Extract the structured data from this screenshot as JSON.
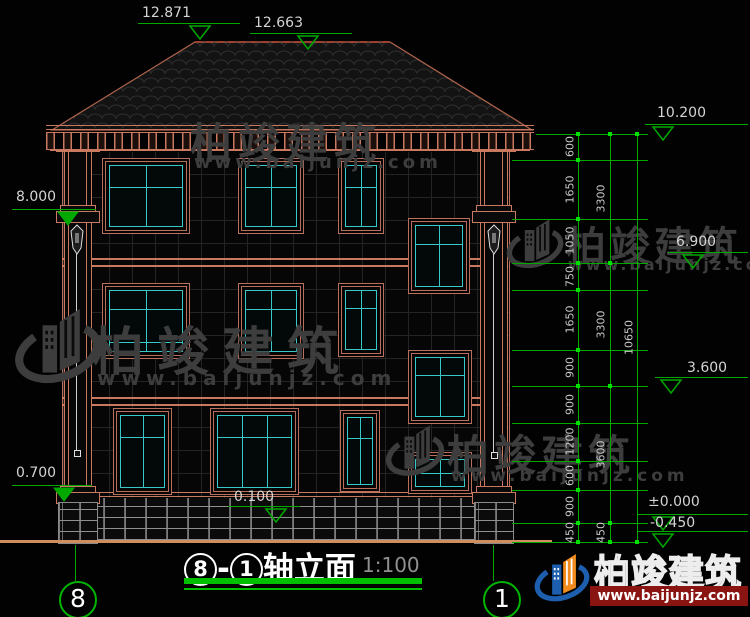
{
  "drawing": {
    "title": {
      "axis_from": "8",
      "axis_to": "1",
      "name": "轴立面",
      "scale": "1:100"
    },
    "axis_bubbles": {
      "left": "8",
      "right": "1"
    },
    "elevations": {
      "roof_peak": "12.871",
      "roof_ridge": "12.663",
      "left_eave": "8.000",
      "left_base": "0.700",
      "entry": "0.100",
      "right_top": "10.200",
      "right_f2": "6.900",
      "right_f1": "3.600",
      "right_zero": "±0.000",
      "right_ground": "-0.450"
    },
    "dims": {
      "chain_inner": [
        "600",
        "1650",
        "1050",
        "750",
        "1650",
        "900",
        "900",
        "1200",
        "600",
        "900",
        "450"
      ],
      "chain_mid": [
        "3300",
        "3300",
        "3600",
        "450"
      ],
      "chain_outer": [
        "10650"
      ]
    }
  },
  "watermark": {
    "brand": "柏竣建筑",
    "site": "www.baijunjz.com"
  },
  "logo": {
    "brand": "柏竣建筑",
    "site": "www.baijunjz.com"
  },
  "colors": {
    "dim_green": "#00a800",
    "tick_green": "#00e000",
    "wall_line": "#b8705c",
    "window_teal": "#38c8c8",
    "ground": "#cf8d60",
    "logo_blue": "#1d5fae",
    "logo_orange": "#f08c1e",
    "banner_red": "#8a1412"
  }
}
